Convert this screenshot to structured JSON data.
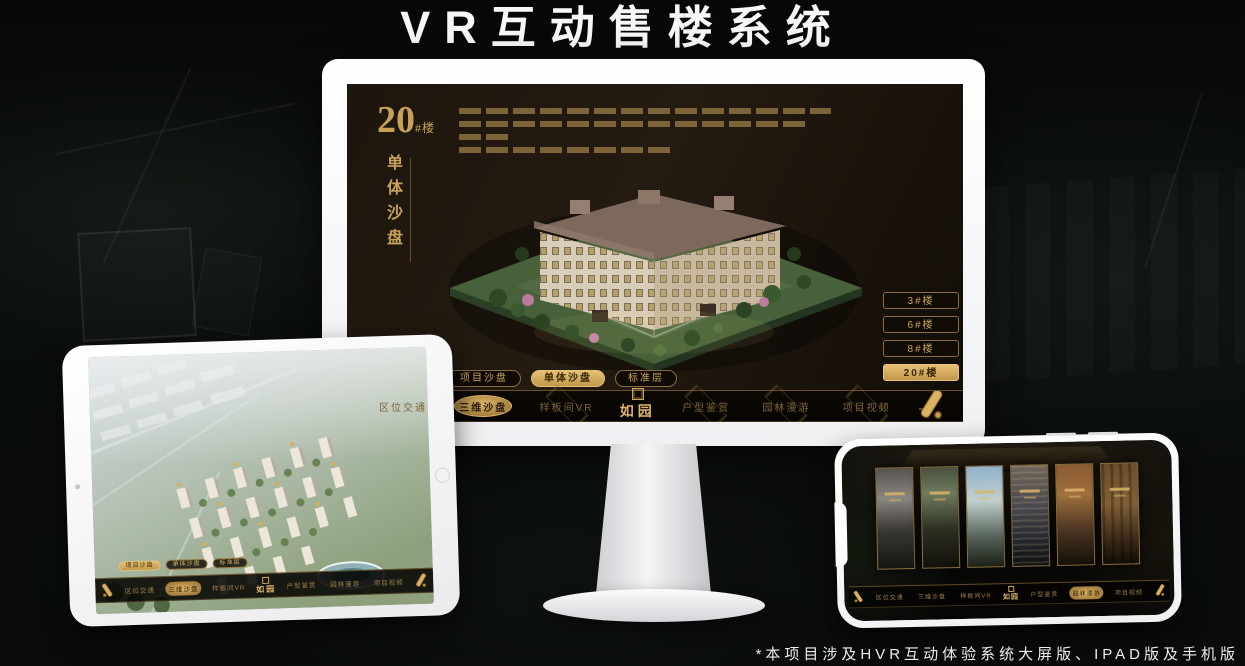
{
  "page": {
    "title": "VR互动售楼系统",
    "footnote": "*本项目涉及HVR互动体验系统大屏版、IPAD版及手机版"
  },
  "brand": {
    "logo": "如园",
    "gold": "#c9a45c",
    "gold_bright": "#ddb469",
    "screen_bg": "#1d160e"
  },
  "monitor_ui": {
    "floor_number": "20",
    "floor_suffix": "#楼",
    "panel_subtitle": "单体沙盘",
    "floor_buttons": [
      {
        "label": "3#楼",
        "active": false
      },
      {
        "label": "6#楼",
        "active": false
      },
      {
        "label": "8#楼",
        "active": false
      },
      {
        "label": "20#楼",
        "active": true
      }
    ],
    "view_tabs": [
      {
        "label": "项目沙盘",
        "active": false
      },
      {
        "label": "单体沙盘",
        "active": true
      },
      {
        "label": "标准层",
        "active": false
      }
    ],
    "nav": {
      "items_left": [
        {
          "label": "区位交通",
          "active": false
        },
        {
          "label": "三维沙盘",
          "active": true
        },
        {
          "label": "样板间VR",
          "active": false
        }
      ],
      "items_right": [
        {
          "label": "户型鉴赏",
          "active": false
        },
        {
          "label": "园林漫游",
          "active": false
        },
        {
          "label": "项目视频",
          "active": false
        }
      ]
    }
  },
  "tablet_ui": {
    "view_tabs": [
      {
        "label": "项目沙盘",
        "active": true
      },
      {
        "label": "单体沙盘",
        "active": false
      },
      {
        "label": "标准层",
        "active": false
      }
    ],
    "nav": {
      "items_left": [
        {
          "label": "区位交通",
          "active": false
        },
        {
          "label": "三维沙盘",
          "active": true
        },
        {
          "label": "样板间VR",
          "active": false
        }
      ],
      "items_right": [
        {
          "label": "户型鉴赏",
          "active": false
        },
        {
          "label": "园林漫游",
          "active": false
        },
        {
          "label": "项目视频",
          "active": false
        }
      ]
    }
  },
  "phone_ui": {
    "nav": {
      "items_left": [
        {
          "label": "区位交通",
          "active": false
        },
        {
          "label": "三维沙盘",
          "active": false
        },
        {
          "label": "样板间VR",
          "active": false
        }
      ],
      "items_right": [
        {
          "label": "户型鉴赏",
          "active": false
        },
        {
          "label": "园林漫游",
          "active": true
        },
        {
          "label": "项目视频",
          "active": false
        }
      ]
    }
  }
}
